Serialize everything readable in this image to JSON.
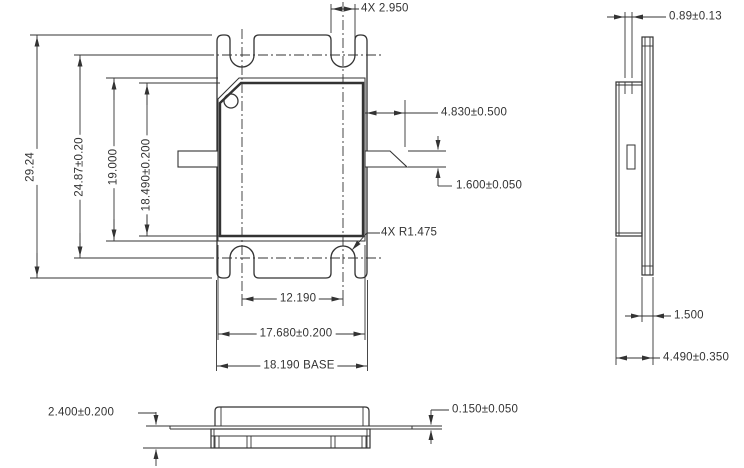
{
  "drawing": {
    "front_view": {
      "slot_width": "4X 2.950",
      "overall_height": "29.24",
      "slot_center_span": "24.87±0.20",
      "lid_height": "19.000",
      "body_height": "18.490±0.200",
      "lead_length": "4.830±0.500",
      "lead_width": "1.600±0.050",
      "slot_radius": "4X R1.475",
      "slot_pitch": "12.190",
      "body_width": "17.680±0.200",
      "base_width": "18.190 BASE"
    },
    "side_view": {
      "lip_thickness": "0.89±0.13",
      "flange_thickness": "1.500",
      "overall_thickness": "4.490±0.350"
    },
    "bottom_view": {
      "base_height": "2.400±0.200",
      "lead_thickness": "0.150±0.050"
    }
  },
  "colors": {
    "line": "#333333",
    "background": "#ffffff"
  }
}
